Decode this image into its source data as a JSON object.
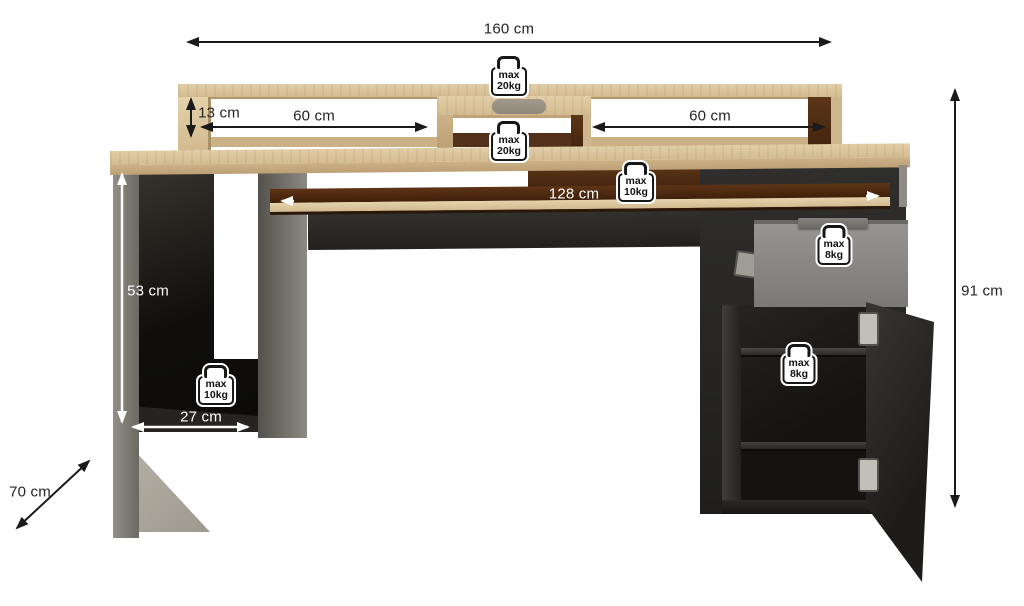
{
  "diagram": {
    "type": "furniture-dimension-diagram",
    "subject": "desk with hutch shelf, monitor stand, keyboard tray, open side compartment, drawer and cabinet",
    "background": "#ffffff"
  },
  "dimensions": {
    "total_width": "160 cm",
    "hutch_height": "13 cm",
    "hutch_left_opening": "60 cm",
    "hutch_right_opening": "60 cm",
    "keyboard_tray_width": "128 cm",
    "side_compartment_height": "53 cm",
    "side_compartment_depth": "27 cm",
    "desk_depth": "70 cm",
    "total_height": "91 cm"
  },
  "weight_limits": {
    "hutch_top": {
      "line1": "max",
      "line2": "20kg"
    },
    "monitor_shelf": {
      "line1": "max",
      "line2": "20kg"
    },
    "keyboard_tray": {
      "line1": "max",
      "line2": "10kg"
    },
    "side_compartment": {
      "line1": "max",
      "line2": "10kg"
    },
    "drawer": {
      "line1": "max",
      "line2": "8kg"
    },
    "cabinet_shelf": {
      "line1": "max",
      "line2": "8kg"
    }
  },
  "colors": {
    "oak": "#d5bf97",
    "oak_dark": "#bda075",
    "dark_brown": "#4a2a12",
    "graphite": "#2a2927",
    "graphite_dark": "#191816",
    "gray_panel": "#807d76",
    "drawer_gray": "#8e8d8a",
    "foot_gray": "#aba69b",
    "arrow_black": "#1a1a1a",
    "arrow_white": "#ffffff"
  }
}
